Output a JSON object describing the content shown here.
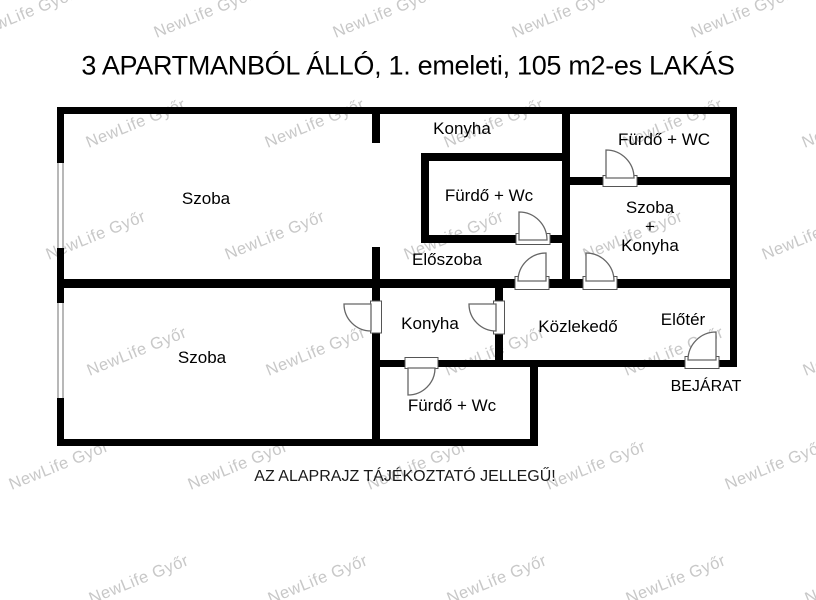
{
  "title": "3 APARTMANBÓL ÁLLÓ, 1. emeleti, 105 m2-es LAKÁS",
  "disclaimer": "AZ ALAPRAJZ TÁJÉKOZTATÓ JELLEGŰ!",
  "watermark": {
    "text": "NewLife Győr",
    "color": "#c8c8c8"
  },
  "colors": {
    "wall": "#000000",
    "door_line": "#666666"
  },
  "labels": {
    "szoba_top": "Szoba",
    "konyha_top": "Konyha",
    "furdo_mid": "Fürdő + Wc",
    "furdo_topright": "Fürdő + WC",
    "szoba_konyha_1": "Szoba",
    "szoba_konyha_2": "+",
    "szoba_konyha_3": "Konyha",
    "eloszoba": "Előszoba",
    "szoba_bottom": "Szoba",
    "konyha_bottom": "Konyha",
    "furdo_bottom": "Fürdő + Wc",
    "kozlekedo": "Közlekedő",
    "eloter": "Előtér",
    "bejarat": "BEJÁRAT"
  }
}
